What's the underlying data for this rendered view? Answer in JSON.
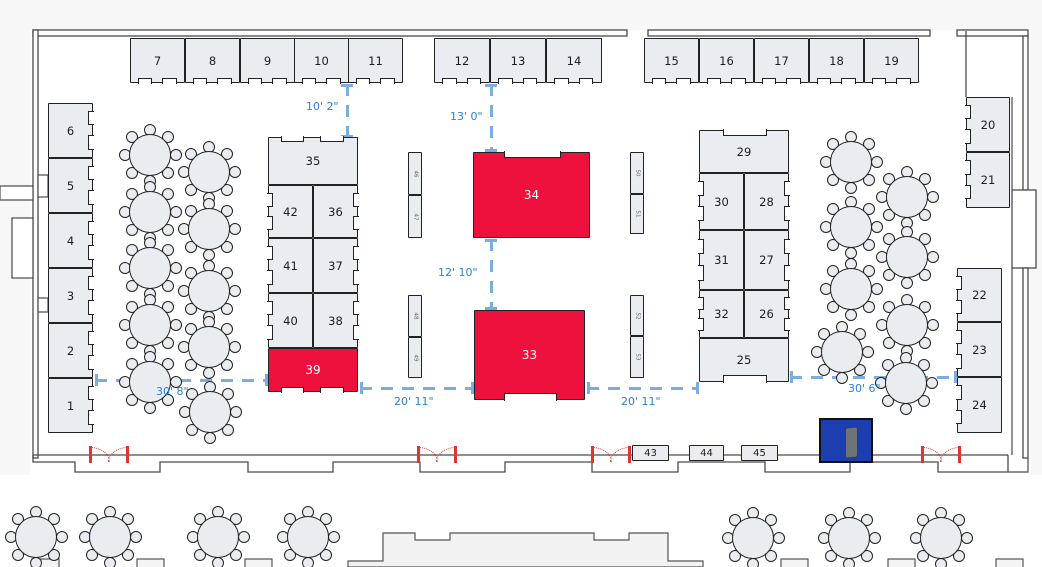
{
  "colors": {
    "booth_fill": "#e9edf1",
    "booth_border": "#222222",
    "highlight_red": "#ee113d",
    "label_color": "#1c1c1c",
    "label_on_red": "#ffffff",
    "measure_line_blue": "#7badde",
    "measure_text_blue": "#2e7fd2",
    "door_red": "#e0342e",
    "object_blue": "#1d3eb1",
    "wall_gray": "#4a4a4a",
    "lobby_fill": "#f2f2f2"
  },
  "booths": [
    {
      "label": "7",
      "x": 130,
      "y": 38,
      "w": 55,
      "h": 45,
      "fill": "gray",
      "notch": "bottom-pair"
    },
    {
      "label": "8",
      "x": 185,
      "y": 38,
      "w": 55,
      "h": 45,
      "fill": "gray",
      "notch": "bottom-pair"
    },
    {
      "label": "9",
      "x": 240,
      "y": 38,
      "w": 55,
      "h": 45,
      "fill": "gray",
      "notch": "bottom-pair"
    },
    {
      "label": "10",
      "x": 294,
      "y": 38,
      "w": 55,
      "h": 45,
      "fill": "gray",
      "notch": "bottom-pair"
    },
    {
      "label": "11",
      "x": 348,
      "y": 38,
      "w": 55,
      "h": 45,
      "fill": "gray",
      "notch": "bottom-pair"
    },
    {
      "label": "12",
      "x": 434,
      "y": 38,
      "w": 56,
      "h": 45,
      "fill": "gray",
      "notch": "bottom-pair"
    },
    {
      "label": "13",
      "x": 490,
      "y": 38,
      "w": 56,
      "h": 45,
      "fill": "gray",
      "notch": "bottom-pair"
    },
    {
      "label": "14",
      "x": 546,
      "y": 38,
      "w": 56,
      "h": 45,
      "fill": "gray",
      "notch": "bottom-pair"
    },
    {
      "label": "15",
      "x": 644,
      "y": 38,
      "w": 55,
      "h": 45,
      "fill": "gray",
      "notch": "bottom-pair"
    },
    {
      "label": "16",
      "x": 699,
      "y": 38,
      "w": 55,
      "h": 45,
      "fill": "gray",
      "notch": "bottom-pair"
    },
    {
      "label": "17",
      "x": 754,
      "y": 38,
      "w": 55,
      "h": 45,
      "fill": "gray",
      "notch": "bottom-pair"
    },
    {
      "label": "18",
      "x": 809,
      "y": 38,
      "w": 55,
      "h": 45,
      "fill": "gray",
      "notch": "bottom-pair"
    },
    {
      "label": "19",
      "x": 864,
      "y": 38,
      "w": 55,
      "h": 45,
      "fill": "gray",
      "notch": "bottom-pair"
    },
    {
      "label": "6",
      "x": 48,
      "y": 103,
      "w": 45,
      "h": 55,
      "fill": "gray",
      "notch": "right-pair"
    },
    {
      "label": "5",
      "x": 48,
      "y": 158,
      "w": 45,
      "h": 55,
      "fill": "gray",
      "notch": "right-pair"
    },
    {
      "label": "4",
      "x": 48,
      "y": 213,
      "w": 45,
      "h": 55,
      "fill": "gray",
      "notch": "right-pair"
    },
    {
      "label": "3",
      "x": 48,
      "y": 268,
      "w": 45,
      "h": 55,
      "fill": "gray",
      "notch": "right-pair"
    },
    {
      "label": "2",
      "x": 48,
      "y": 323,
      "w": 45,
      "h": 55,
      "fill": "gray",
      "notch": "right-pair"
    },
    {
      "label": "1",
      "x": 48,
      "y": 378,
      "w": 45,
      "h": 55,
      "fill": "gray",
      "notch": "right-pair"
    },
    {
      "label": "35",
      "x": 268,
      "y": 137,
      "w": 90,
      "h": 48,
      "fill": "gray",
      "notch": "top-pair"
    },
    {
      "label": "42",
      "x": 268,
      "y": 185,
      "w": 45,
      "h": 53,
      "fill": "gray",
      "notch": "left-pair"
    },
    {
      "label": "36",
      "x": 313,
      "y": 185,
      "w": 45,
      "h": 53,
      "fill": "gray",
      "notch": "right-pair"
    },
    {
      "label": "41",
      "x": 268,
      "y": 238,
      "w": 45,
      "h": 55,
      "fill": "gray",
      "notch": "left-pair"
    },
    {
      "label": "37",
      "x": 313,
      "y": 238,
      "w": 45,
      "h": 55,
      "fill": "gray",
      "notch": "right-pair"
    },
    {
      "label": "40",
      "x": 268,
      "y": 293,
      "w": 45,
      "h": 55,
      "fill": "gray",
      "notch": "left-pair"
    },
    {
      "label": "38",
      "x": 313,
      "y": 293,
      "w": 45,
      "h": 55,
      "fill": "gray",
      "notch": "right-pair"
    },
    {
      "label": "39",
      "x": 268,
      "y": 348,
      "w": 90,
      "h": 44,
      "fill": "red",
      "notch": "bottom-pair"
    },
    {
      "label": "29",
      "x": 699,
      "y": 130,
      "w": 90,
      "h": 43,
      "fill": "gray",
      "notch": "top-wide"
    },
    {
      "label": "30",
      "x": 699,
      "y": 173,
      "w": 45,
      "h": 57,
      "fill": "gray",
      "notch": "left-pair"
    },
    {
      "label": "28",
      "x": 744,
      "y": 173,
      "w": 45,
      "h": 57,
      "fill": "gray",
      "notch": "right-pair"
    },
    {
      "label": "31",
      "x": 699,
      "y": 230,
      "w": 45,
      "h": 60,
      "fill": "gray",
      "notch": "left-pair"
    },
    {
      "label": "27",
      "x": 744,
      "y": 230,
      "w": 45,
      "h": 60,
      "fill": "gray",
      "notch": "right-pair"
    },
    {
      "label": "32",
      "x": 699,
      "y": 290,
      "w": 45,
      "h": 48,
      "fill": "gray",
      "notch": "left-pair"
    },
    {
      "label": "26",
      "x": 744,
      "y": 290,
      "w": 45,
      "h": 48,
      "fill": "gray",
      "notch": "right-pair"
    },
    {
      "label": "25",
      "x": 699,
      "y": 338,
      "w": 90,
      "h": 44,
      "fill": "gray",
      "notch": "bottom-wide"
    },
    {
      "label": "20",
      "x": 966,
      "y": 97,
      "w": 44,
      "h": 55,
      "fill": "gray",
      "notch": "left-pair"
    },
    {
      "label": "21",
      "x": 966,
      "y": 152,
      "w": 44,
      "h": 56,
      "fill": "gray",
      "notch": "left-pair"
    },
    {
      "label": "22",
      "x": 957,
      "y": 268,
      "w": 45,
      "h": 54,
      "fill": "gray",
      "notch": "left-pair"
    },
    {
      "label": "23",
      "x": 957,
      "y": 322,
      "w": 45,
      "h": 55,
      "fill": "gray",
      "notch": "left-pair"
    },
    {
      "label": "24",
      "x": 957,
      "y": 377,
      "w": 45,
      "h": 56,
      "fill": "gray",
      "notch": "left-pair"
    },
    {
      "label": "34",
      "x": 473,
      "y": 152,
      "w": 117,
      "h": 86,
      "fill": "red",
      "notch": "top-wide"
    },
    {
      "label": "33",
      "x": 474,
      "y": 310,
      "w": 111,
      "h": 90,
      "fill": "red",
      "notch": "bottom-wide"
    },
    {
      "label": "43",
      "x": 632,
      "y": 445,
      "w": 37,
      "h": 16,
      "fill": "gray",
      "notch": "none",
      "small": true
    },
    {
      "label": "44",
      "x": 689,
      "y": 445,
      "w": 35,
      "h": 16,
      "fill": "gray",
      "notch": "none",
      "small": true
    },
    {
      "label": "45",
      "x": 741,
      "y": 445,
      "w": 37,
      "h": 16,
      "fill": "gray",
      "notch": "none",
      "small": true
    },
    {
      "label": "46",
      "x": 408,
      "y": 152,
      "w": 14,
      "h": 43,
      "fill": "gray",
      "notch": "none",
      "vert": true
    },
    {
      "label": "47",
      "x": 408,
      "y": 195,
      "w": 14,
      "h": 43,
      "fill": "gray",
      "notch": "none",
      "vert": true
    },
    {
      "label": "48",
      "x": 408,
      "y": 295,
      "w": 14,
      "h": 42,
      "fill": "gray",
      "notch": "none",
      "vert": true
    },
    {
      "label": "49",
      "x": 408,
      "y": 337,
      "w": 14,
      "h": 41,
      "fill": "gray",
      "notch": "none",
      "vert": true
    },
    {
      "label": "50",
      "x": 630,
      "y": 152,
      "w": 14,
      "h": 42,
      "fill": "gray",
      "notch": "none",
      "vert": true
    },
    {
      "label": "51",
      "x": 630,
      "y": 194,
      "w": 14,
      "h": 40,
      "fill": "gray",
      "notch": "none",
      "vert": true
    },
    {
      "label": "52",
      "x": 630,
      "y": 295,
      "w": 14,
      "h": 41,
      "fill": "gray",
      "notch": "none",
      "vert": true
    },
    {
      "label": "53",
      "x": 630,
      "y": 336,
      "w": 14,
      "h": 42,
      "fill": "gray",
      "notch": "none",
      "vert": true
    }
  ],
  "measurements": [
    {
      "label": "10' 2\"",
      "dir": "v",
      "x": 347,
      "y1": 84,
      "y2": 137,
      "lx": 306,
      "ly": 100
    },
    {
      "label": "13' 0\"",
      "dir": "v",
      "x": 491,
      "y1": 84,
      "y2": 151,
      "lx": 450,
      "ly": 110
    },
    {
      "label": "12' 10\"",
      "dir": "v",
      "x": 491,
      "y1": 239,
      "y2": 309,
      "lx": 438,
      "ly": 266
    },
    {
      "label": "30' 8\"",
      "dir": "h",
      "y": 380,
      "x1": 95,
      "x2": 267,
      "lx": 156,
      "ly": 385
    },
    {
      "label": "20' 11\"",
      "dir": "h",
      "y": 388,
      "x1": 360,
      "x2": 473,
      "lx": 394,
      "ly": 395
    },
    {
      "label": "20' 11\"",
      "dir": "h",
      "y": 388,
      "x1": 587,
      "x2": 698,
      "lx": 621,
      "ly": 395
    },
    {
      "label": "30' 6\"",
      "dir": "h",
      "y": 377,
      "x1": 790,
      "x2": 956,
      "lx": 848,
      "ly": 382
    }
  ],
  "tables": {
    "interior": [
      [
        150,
        155
      ],
      [
        150,
        212
      ],
      [
        150,
        268
      ],
      [
        150,
        325
      ],
      [
        150,
        382
      ],
      [
        209,
        172
      ],
      [
        209,
        229
      ],
      [
        209,
        291
      ],
      [
        209,
        347
      ],
      [
        210,
        412
      ],
      [
        851,
        162
      ],
      [
        851,
        227
      ],
      [
        851,
        289
      ],
      [
        842,
        352
      ],
      [
        907,
        197
      ],
      [
        907,
        257
      ],
      [
        907,
        325
      ],
      [
        906,
        383
      ]
    ],
    "exterior": [
      [
        36,
        537
      ],
      [
        110,
        537
      ],
      [
        218,
        537
      ],
      [
        308,
        537
      ],
      [
        753,
        538
      ],
      [
        849,
        538
      ],
      [
        941,
        538
      ]
    ],
    "chairs_per_table": 8
  },
  "doors": [
    {
      "x": 89,
      "w": 40
    },
    {
      "x": 417,
      "w": 40
    },
    {
      "x": 591,
      "w": 40
    },
    {
      "x": 921,
      "w": 40
    }
  ],
  "blue_object": {
    "x": 819,
    "y": 418,
    "w": 54,
    "h": 45
  }
}
